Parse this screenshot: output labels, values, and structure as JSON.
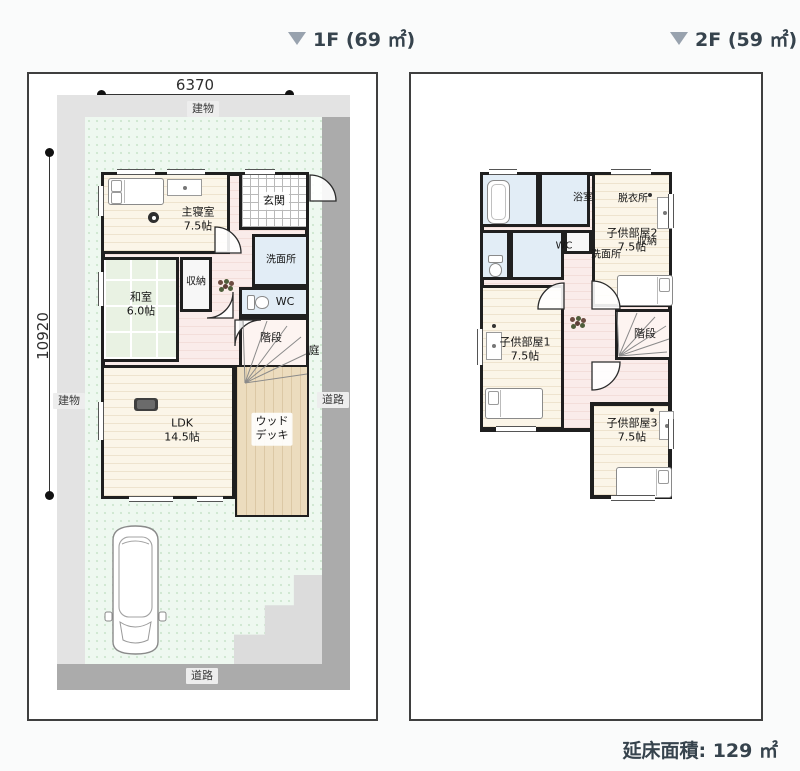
{
  "headers": {
    "floor1": "1F (69 ㎡)",
    "floor2": "2F (59 ㎡)"
  },
  "footer": {
    "total_floor_area": "延床面積: 129 ㎡"
  },
  "floor1": {
    "dim_width": "6370",
    "dim_height": "10920",
    "building_label_top": "建物",
    "building_label_left": "建物",
    "road_label_right": "道路",
    "road_label_bottom": "道路",
    "garden_label": "庭",
    "rooms": {
      "master_bedroom": {
        "name": "主寝室",
        "size": "7.5帖"
      },
      "entrance": {
        "name": "玄関"
      },
      "washroom": {
        "name": "洗面所"
      },
      "wc": {
        "name": "WC"
      },
      "storage": {
        "name": "収納"
      },
      "japanese_room": {
        "name": "和室",
        "size": "6.0帖"
      },
      "stairs": {
        "name": "階段"
      },
      "ldk": {
        "name": "LDK",
        "size": "14.5帖"
      },
      "wood_deck": {
        "line1": "ウッド",
        "line2": "デッキ"
      }
    }
  },
  "floor2": {
    "rooms": {
      "bathroom": {
        "name": "浴室"
      },
      "dressing_room": {
        "name": "脱衣所"
      },
      "wc": {
        "name": "WC"
      },
      "washroom": {
        "name": "洗面所"
      },
      "storage": {
        "name": "収納"
      },
      "child_room_2": {
        "name": "子供部屋2",
        "size": "7.5帖"
      },
      "child_room_1": {
        "name": "子供部屋1",
        "size": "7.5帖"
      },
      "stairs": {
        "name": "階段"
      },
      "child_room_3": {
        "name": "子供部屋3",
        "size": "7.5帖"
      }
    }
  },
  "colors": {
    "header_text": "#36434d",
    "triangle_gray": "#98a2ae",
    "wall_black": "#1f1f1f",
    "lot_green": "#eef8f0",
    "building_gray": "#e3e3e3",
    "road_gray": "#ababab",
    "room_cream": "#fbf5e8",
    "tatami_green": "#e9f2e3",
    "wet_area_blue": "#e2edf6",
    "hall_pink": "#faecea",
    "wood_deck_tan": "#ecdcbe"
  }
}
